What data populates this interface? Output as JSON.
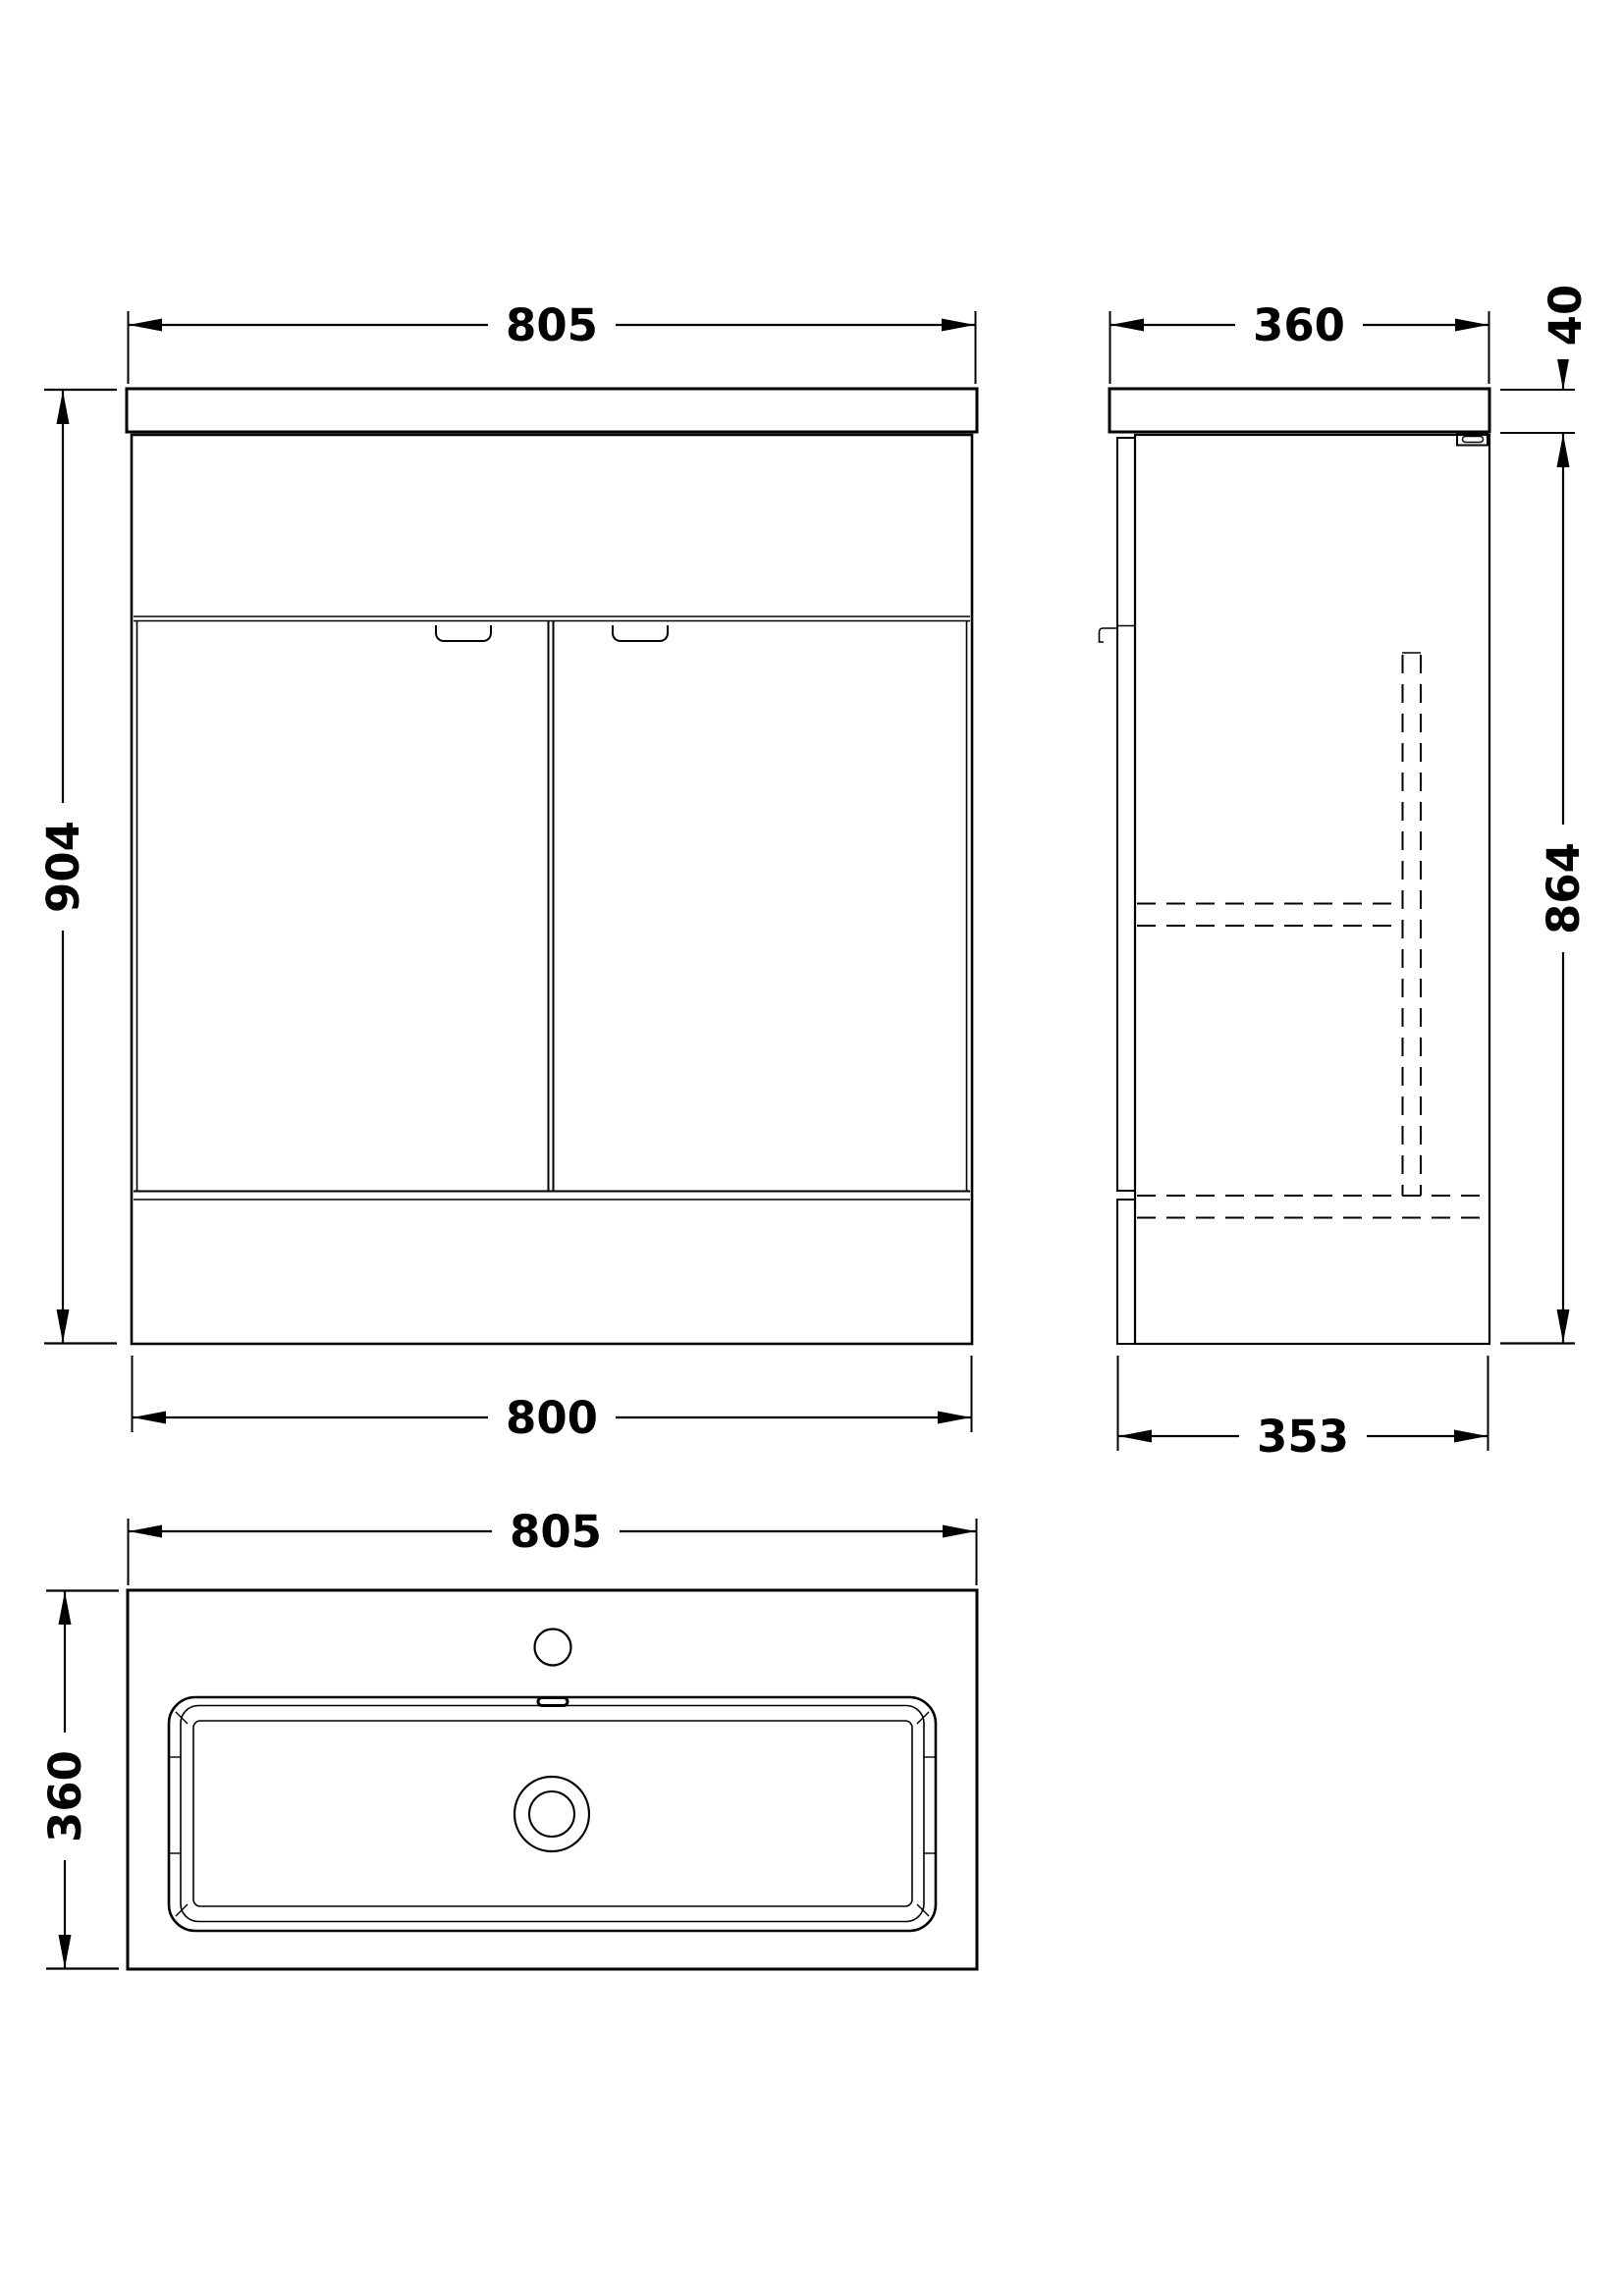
{
  "drawing": {
    "description": "Vanity unit with basin - dimensioned technical drawing, three views",
    "line_color": "#000000",
    "background_color": "#ffffff",
    "views": {
      "front": {
        "label": "front elevation",
        "dims": {
          "top_width": "805",
          "height": "904",
          "bottom_width": "800"
        }
      },
      "side": {
        "label": "side elevation",
        "dims": {
          "top_depth": "360",
          "worktop_thickness": "40",
          "body_height": "864",
          "bottom_depth": "353"
        }
      },
      "plan": {
        "label": "plan view of basin top",
        "dims": {
          "width": "805",
          "depth": "360"
        }
      }
    }
  }
}
